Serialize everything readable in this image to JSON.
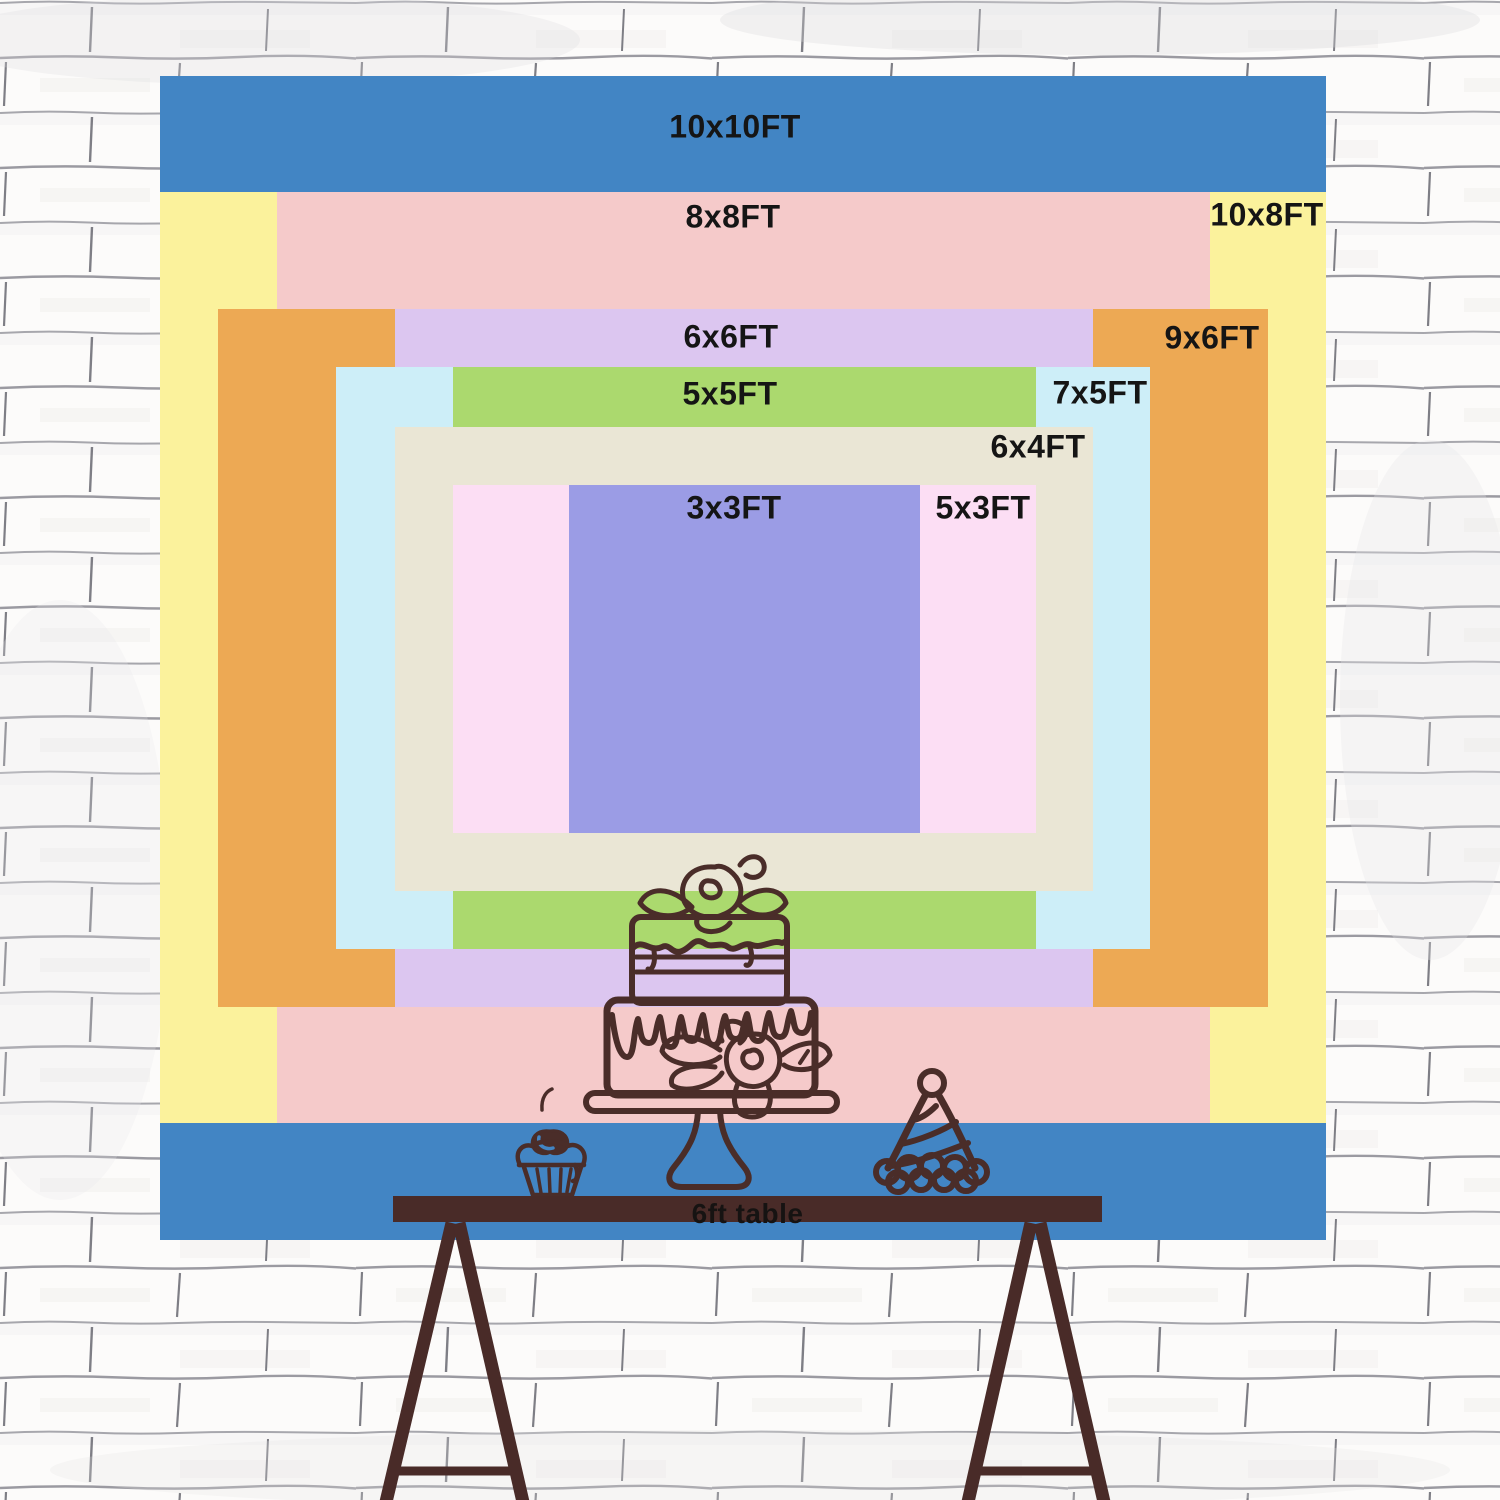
{
  "backdrop": {
    "position": {
      "left": 160,
      "top": 76,
      "width": 1166,
      "height": 1164
    },
    "label_color": "#151515",
    "layers": [
      {
        "id": "10x10",
        "label": "10x10FT",
        "width_ft": 10,
        "height_ft": 10,
        "color": "#4285c4",
        "rect": {
          "left": 0,
          "top": 0,
          "width": 1166,
          "height": 1164
        },
        "label_pos": {
          "x": 575,
          "y": 51
        }
      },
      {
        "id": "10x8",
        "label": "10x8FT",
        "width_ft": 10,
        "height_ft": 8,
        "color": "#fbf29c",
        "rect": {
          "left": 0,
          "top": 116,
          "width": 1166,
          "height": 931
        },
        "label_pos": {
          "x": 1107,
          "y": 139
        }
      },
      {
        "id": "8x8",
        "label": "8x8FT",
        "width_ft": 8,
        "height_ft": 8,
        "color": "#f5caca",
        "rect": {
          "left": 117,
          "top": 116,
          "width": 933,
          "height": 931
        },
        "label_pos": {
          "x": 573,
          "y": 141
        }
      },
      {
        "id": "9x6",
        "label": "9x6FT",
        "width_ft": 9,
        "height_ft": 6,
        "color": "#eda954",
        "rect": {
          "left": 58,
          "top": 233,
          "width": 1050,
          "height": 698
        },
        "label_pos": {
          "x": 1052,
          "y": 262
        }
      },
      {
        "id": "6x6",
        "label": "6x6FT",
        "width_ft": 6,
        "height_ft": 6,
        "color": "#dcc6f0",
        "rect": {
          "left": 235,
          "top": 233,
          "width": 698,
          "height": 698
        },
        "label_pos": {
          "x": 571,
          "y": 261
        }
      },
      {
        "id": "7x5",
        "label": "7x5FT",
        "width_ft": 7,
        "height_ft": 5,
        "color": "#cdeef8",
        "rect": {
          "left": 176,
          "top": 291,
          "width": 814,
          "height": 582
        },
        "label_pos": {
          "x": 940,
          "y": 317
        }
      },
      {
        "id": "5x5",
        "label": "5x5FT",
        "width_ft": 5,
        "height_ft": 5,
        "color": "#abd96e",
        "rect": {
          "left": 293,
          "top": 291,
          "width": 583,
          "height": 582
        },
        "label_pos": {
          "x": 570,
          "y": 318
        }
      },
      {
        "id": "6x4",
        "label": "6x4FT",
        "width_ft": 6,
        "height_ft": 4,
        "color": "#eae6d5",
        "rect": {
          "left": 235,
          "top": 351,
          "width": 698,
          "height": 464
        },
        "label_pos": {
          "x": 878,
          "y": 371
        }
      },
      {
        "id": "5x3",
        "label": "5x3FT",
        "width_ft": 5,
        "height_ft": 3,
        "color": "#fcdef4",
        "rect": {
          "left": 293,
          "top": 409,
          "width": 583,
          "height": 348
        },
        "label_pos": {
          "x": 823,
          "y": 432
        }
      },
      {
        "id": "3x3",
        "label": "3x3FT",
        "width_ft": 3,
        "height_ft": 3,
        "color": "#9b9ce5",
        "rect": {
          "left": 409,
          "top": 409,
          "width": 351,
          "height": 348
        },
        "label_pos": {
          "x": 574,
          "y": 432
        }
      }
    ]
  },
  "table": {
    "label": "6ft table",
    "color": "#492b28",
    "label_color": "#161312"
  },
  "illustration": {
    "stroke": "#4a2d29",
    "items": [
      "birthday-cake",
      "cupcake-with-cherry",
      "party-hat"
    ]
  },
  "wall": {
    "base": "#f8f7f5",
    "brick": "#fcfbfa",
    "mortar": "#8a8a92",
    "joint": "#5f5f68"
  }
}
